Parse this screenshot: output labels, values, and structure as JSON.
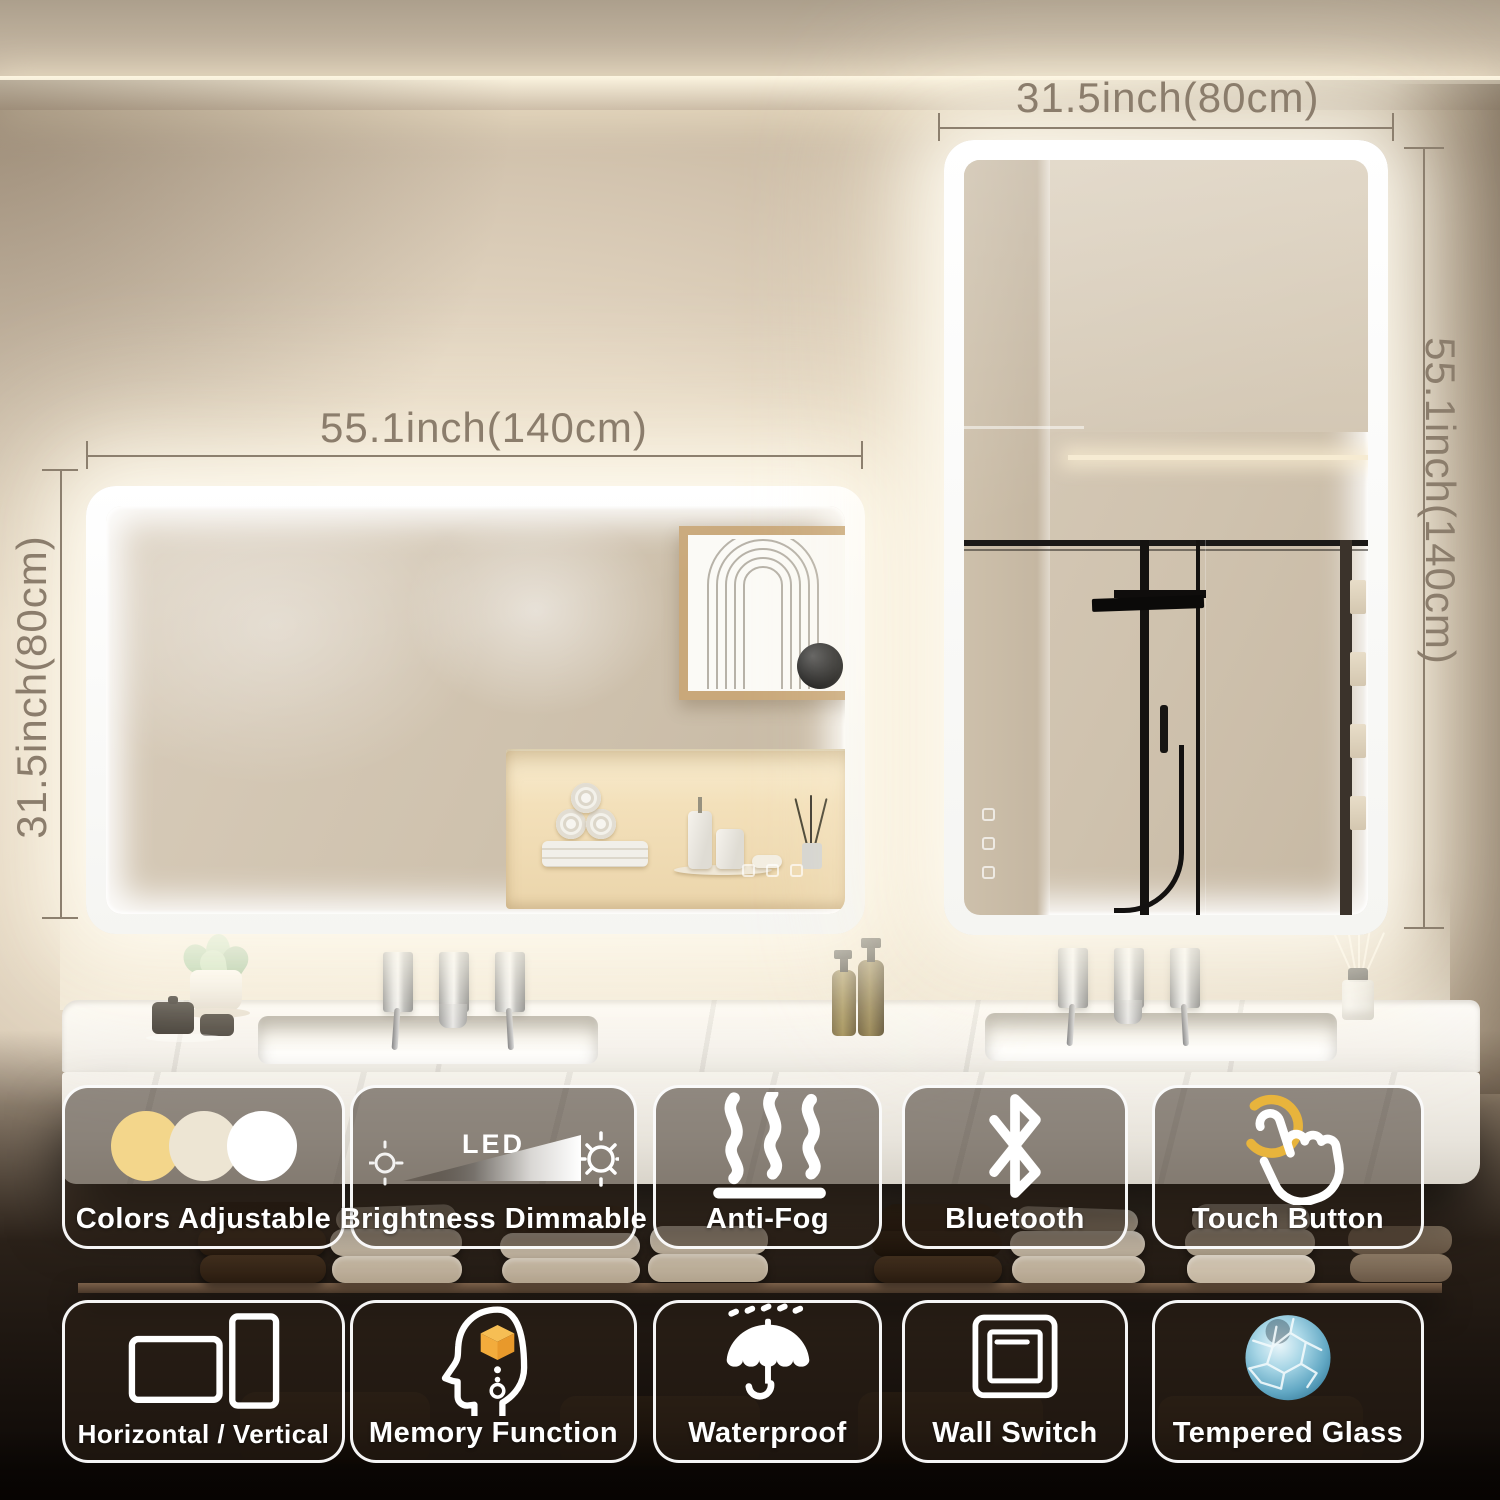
{
  "scene": {
    "type": "led-bathroom-mirror-product-photo",
    "glow_color": "#FFF8E6",
    "wall_color": "#E4D7C3",
    "lower_wall_color": "#1E150E",
    "counter_color": "#F5F2EC"
  },
  "dimension_labels": {
    "right_mirror_width": "31.5inch(80cm)",
    "left_mirror_width": "55.1inch(140cm)",
    "left_mirror_height": "31.5inch(80cm)",
    "right_mirror_height": "55.1inch(140cm)"
  },
  "features": {
    "row1": [
      {
        "label": "Colors Adjustable",
        "icon": "color-temperature-circles-icon",
        "swatches": [
          "#F3D68B",
          "#EDE5D3",
          "#FFFFFF"
        ]
      },
      {
        "label": "Brightness Dimmable",
        "icon": "led-brightness-gradient-icon",
        "overlay_text": "LED"
      },
      {
        "label": "Anti-Fog",
        "icon": "steam-waves-icon"
      },
      {
        "label": "Bluetooth",
        "icon": "bluetooth-icon"
      },
      {
        "label": "Touch Button",
        "icon": "touch-finger-icon",
        "highlight_color": "#E8B43C"
      }
    ],
    "row2": [
      {
        "label": "Horizontal / Vertical",
        "icon": "orientation-rectangles-icon"
      },
      {
        "label": "Memory Function",
        "icon": "memory-head-cube-icon",
        "cube_color": "#F3AC3C"
      },
      {
        "label": "Waterproof",
        "icon": "umbrella-rain-icon"
      },
      {
        "label": "Wall Switch",
        "icon": "wall-switch-icon"
      },
      {
        "label": "Tempered Glass",
        "icon": "shattered-glass-icon",
        "glass_color": "#7FC3DC"
      }
    ]
  }
}
